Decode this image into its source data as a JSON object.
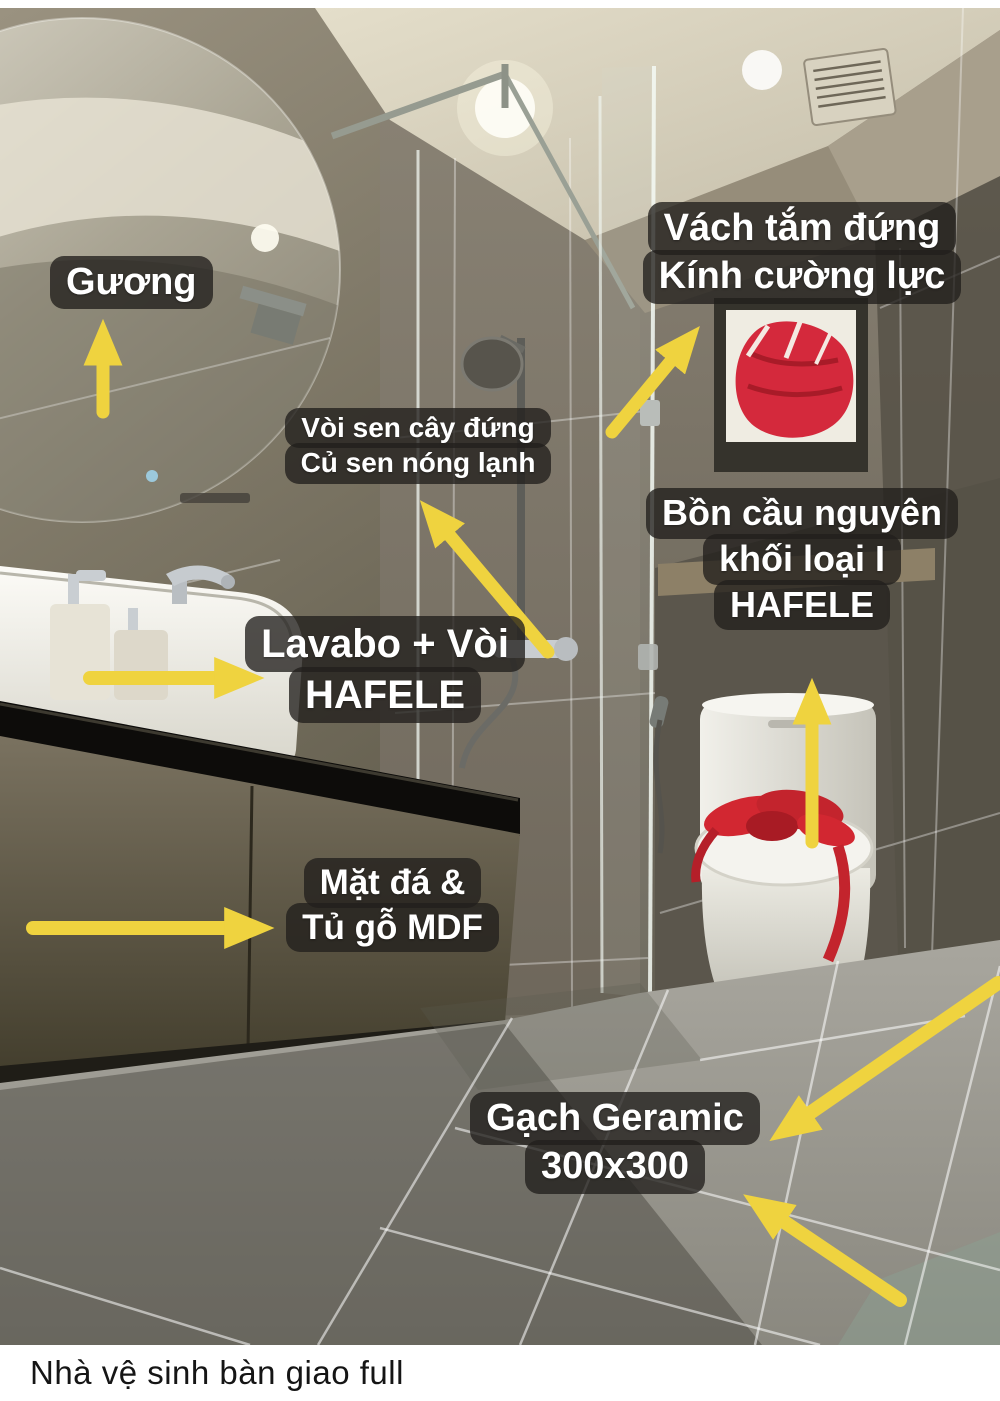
{
  "colors": {
    "arrow": "#EFD33F",
    "label_background": "rgba(33,31,28,0.78)",
    "label_text": "#FFFFFF",
    "caption_text": "#151515",
    "caption_background": "#FFFFFF"
  },
  "annotations": {
    "mirror": {
      "lines": [
        "Gương"
      ]
    },
    "shower_glass": {
      "lines": [
        "Vách tắm đứng",
        "Kính cường lực"
      ]
    },
    "shower_set": {
      "lines": [
        "Vòi sen cây đứng",
        "Củ sen nóng lạnh"
      ]
    },
    "toilet": {
      "lines": [
        "Bồn cầu nguyên",
        "khối loại I",
        "HAFELE"
      ]
    },
    "sink": {
      "lines": [
        "Lavabo + Vòi",
        "HAFELE"
      ]
    },
    "vanity": {
      "lines": [
        "Mặt đá &",
        "Tủ gỗ MDF"
      ]
    },
    "floor_tile": {
      "lines": [
        "Gạch Geramic",
        "300x300"
      ]
    }
  },
  "caption": "Nhà vệ sinh bàn giao full"
}
